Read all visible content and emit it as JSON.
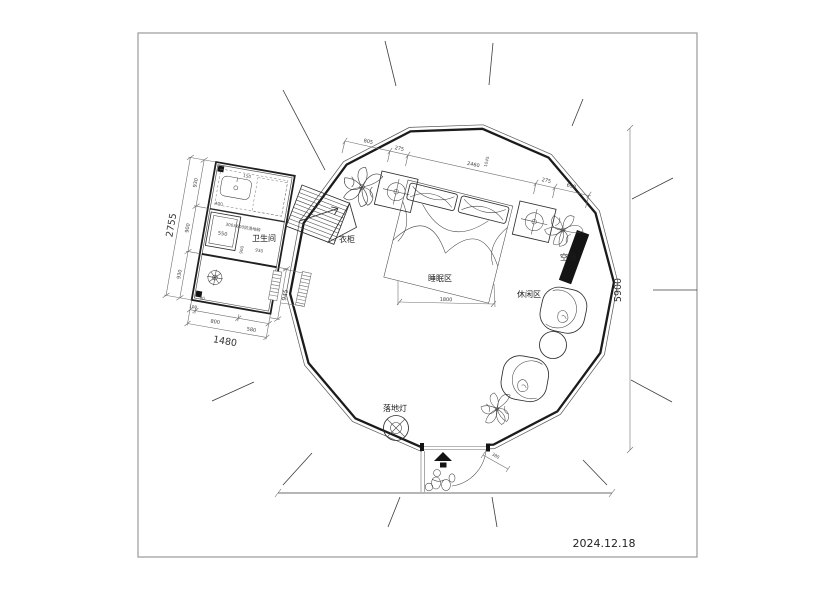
{
  "meta": {
    "date": "2024.12.18"
  },
  "labels": {
    "bathroom": "卫生间",
    "wardrobe": "衣柜",
    "sleeping_area": "睡眠区",
    "leisure_area": "休闲区",
    "air_conditioner": "空调",
    "floor_lamp": "落地灯"
  },
  "notes": {
    "floor_tile": "300X600防滑地砖"
  },
  "dimensions": {
    "top_chain": [
      "805",
      "275",
      "2460",
      "1045",
      "275",
      "690"
    ],
    "overall_height": "5900",
    "bed_width": "1800",
    "entry_step": "380",
    "bathroom_left": [
      "930",
      "900",
      "930"
    ],
    "bathroom_left_total": "2755",
    "bathroom_bottom": [
      "100",
      "800",
      "580"
    ],
    "bathroom_bottom_total": "1480",
    "bathroom_right": "945",
    "shower": "550",
    "inner_a": "930",
    "inner_b": "900",
    "inner_c": "400",
    "inner_d": "150",
    "inner_e": "90"
  }
}
